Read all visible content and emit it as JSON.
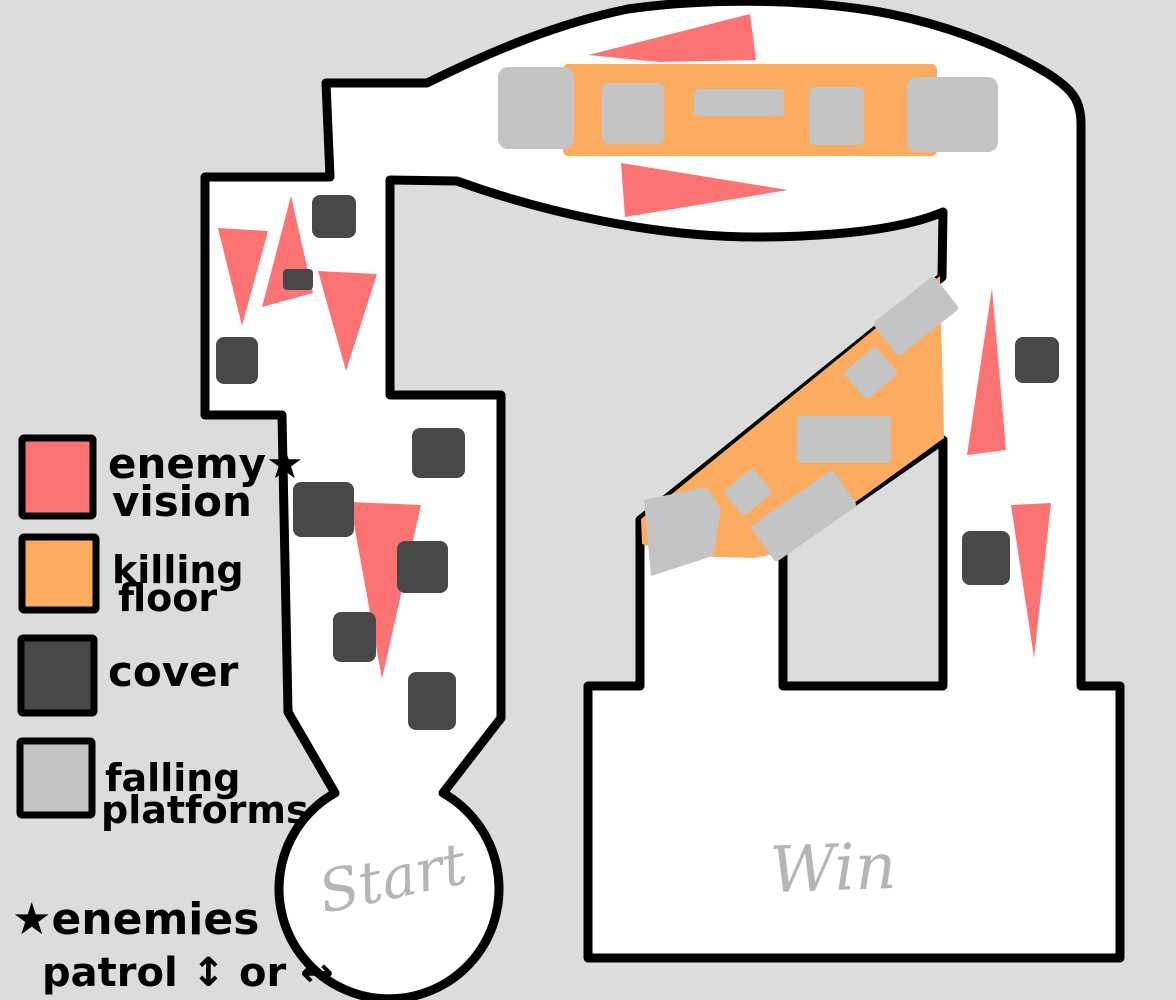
{
  "colors": {
    "background": "#DCDCDC",
    "floor": "#FFFFFF",
    "outline": "#000000",
    "enemy_vision": "#FB7373",
    "killing_floor": "#FCAC60",
    "cover": "#484848",
    "falling_platform": "#C4C4C4",
    "room_label_gray": "#B5B5B5",
    "legend_text": "#000000"
  },
  "legend": {
    "items": [
      {
        "id": "enemy-vision",
        "line1": "enemy★",
        "line2": "vision"
      },
      {
        "id": "killing-floor",
        "line1": "killing",
        "line2": "floor"
      },
      {
        "id": "cover",
        "line1": "cover",
        "line2": ""
      },
      {
        "id": "falling-platforms",
        "line1": "falling",
        "line2": "platforms"
      }
    ]
  },
  "footnote": {
    "line1": "★enemies",
    "line2": "patrol ↕ or ↔"
  },
  "map": {
    "start_label": "Start",
    "win_label": "Win"
  }
}
